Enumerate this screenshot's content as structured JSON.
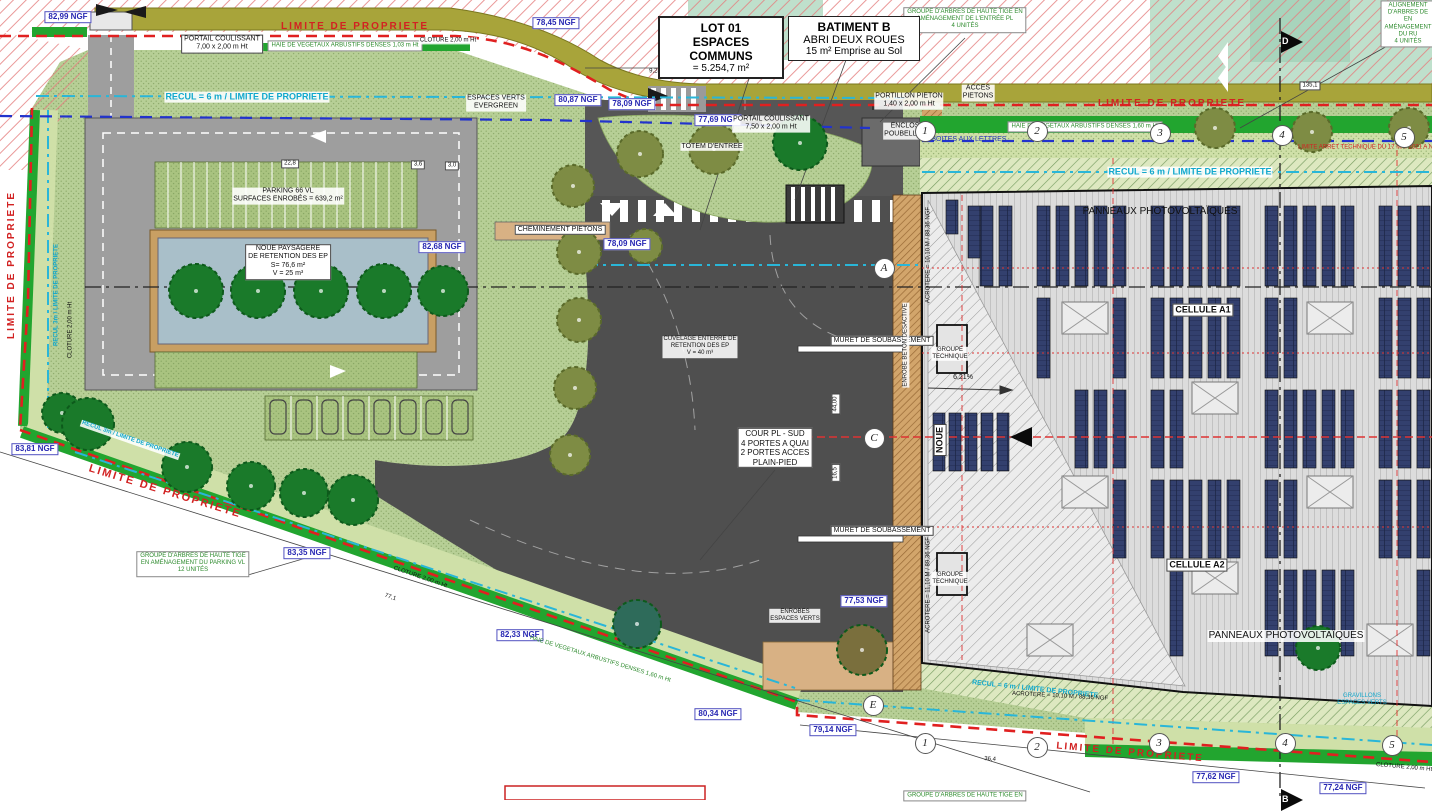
{
  "colors": {
    "grass": "#b7cf96",
    "hedge_green": "#22a52f",
    "light_band": "#cfe0a8",
    "asphalt": "#4f4f4f",
    "parking_gray": "#9e9e9e",
    "noue_blue": "#a9bfc9",
    "path_tan": "#d8b184",
    "roof_gray": "#dcdcdc",
    "panel_navy": "#33406e",
    "property_red": "#d22222",
    "recul_cyan": "#12a8cc",
    "ngf_blue": "#2626b2",
    "outside_hatch_pink": "#e57f7f",
    "verge_olive": "#a8a43a"
  },
  "title_boxes": {
    "lot": {
      "line1": "LOT 01",
      "line2": "ESPACES COMMUNS",
      "line3": "= 5.254,7 m²"
    },
    "batiment": {
      "line1": "BATIMENT B",
      "line2": "ABRI DEUX ROUES",
      "line3": "15 m² Emprise au Sol"
    }
  },
  "annotations": [
    {
      "name": "ngf-label",
      "cls": "ngf",
      "x": 68,
      "y": 17,
      "t": "82,99 NGF"
    },
    {
      "name": "ngf-label",
      "cls": "ngf",
      "x": 556,
      "y": 23,
      "t": "78,45 NGF"
    },
    {
      "name": "ngf-label",
      "cls": "ngf",
      "x": 578,
      "y": 100,
      "t": "80,87 NGF"
    },
    {
      "name": "ngf-label",
      "cls": "ngf",
      "x": 632,
      "y": 104,
      "t": "78,09 NGF"
    },
    {
      "name": "ngf-label",
      "cls": "ngf",
      "x": 718,
      "y": 120,
      "t": "77,69 NGF"
    },
    {
      "name": "ngf-label",
      "cls": "ngf",
      "x": 442,
      "y": 247,
      "t": "82,68 NGF"
    },
    {
      "name": "ngf-label",
      "cls": "ngf",
      "x": 627,
      "y": 244,
      "t": "78,09 NGF"
    },
    {
      "name": "ngf-label",
      "cls": "ngf",
      "x": 35,
      "y": 449,
      "t": "83,81 NGF"
    },
    {
      "name": "ngf-label",
      "cls": "ngf",
      "x": 307,
      "y": 553,
      "t": "83,35 NGF"
    },
    {
      "name": "ngf-label",
      "cls": "ngf",
      "x": 520,
      "y": 635,
      "t": "82,33 NGF"
    },
    {
      "name": "ngf-label",
      "cls": "ngf",
      "x": 864,
      "y": 601,
      "t": "77,53 NGF"
    },
    {
      "name": "ngf-label",
      "cls": "ngf",
      "x": 718,
      "y": 714,
      "t": "80,34 NGF"
    },
    {
      "name": "ngf-label",
      "cls": "ngf",
      "x": 833,
      "y": 730,
      "t": "79,14 NGF"
    },
    {
      "name": "ngf-label",
      "cls": "ngf",
      "x": 1216,
      "y": 777,
      "t": "77,62 NGF"
    },
    {
      "name": "ngf-label",
      "cls": "ngf",
      "x": 1343,
      "y": 788,
      "t": "77,24 NGF"
    },
    {
      "name": "gate-label",
      "cls": "wbox",
      "x": 222,
      "y": 44,
      "t": "PORTAIL COULISSANT\n7,00 x 2,00 m Ht"
    },
    {
      "name": "parking-label",
      "cls": "wbg",
      "x": 288,
      "y": 196,
      "t": "PARKING 66 VL\nSURFACES ENROBÉS = 639,2 m²"
    },
    {
      "name": "noue-label",
      "cls": "wbox",
      "x": 288,
      "y": 262,
      "t": "NOUE PAYSAGERE\nDE RETENTION DES EP\nS= 76,6 m²\nV = 25 m³"
    },
    {
      "name": "path-label",
      "cls": "wbox",
      "x": 560,
      "y": 230,
      "t": "CHEMINEMENT PIETONS"
    },
    {
      "name": "espaces-verts-label",
      "cls": "wbg",
      "x": 496,
      "y": 103,
      "t": "ESPACES VERTS\nEVERGREEN"
    },
    {
      "name": "totem-label",
      "cls": "wbg",
      "x": 712,
      "y": 147,
      "t": "TOTEM D'ENTREE"
    },
    {
      "name": "gate-label",
      "cls": "wbg",
      "x": 771,
      "y": 124,
      "t": "PORTAIL COULISSANT\n7,50 x 2,00 m Ht"
    },
    {
      "name": "portillon-label",
      "cls": "wbg",
      "x": 909,
      "y": 101,
      "t": "PORTILLON PIETON\n1,40 x 2,00 m Ht"
    },
    {
      "name": "acces-pietons-label",
      "cls": "wbg",
      "x": 978,
      "y": 93,
      "t": "ACCES\nPIETONS"
    },
    {
      "name": "enclos-label",
      "cls": "wbg",
      "x": 905,
      "y": 131,
      "t": "ENCLOS\nPOUBELLES"
    },
    {
      "name": "cuvelage-label",
      "cls": "wbg s6",
      "x": 700,
      "y": 347,
      "t": "CUVELAGE ENTERRE DE\nRETENTION DES EP\nV = 40 m³"
    },
    {
      "name": "muret-label",
      "cls": "wbox",
      "x": 882,
      "y": 341,
      "t": "MURET DE SOUBASSEMENT"
    },
    {
      "name": "muret-label",
      "cls": "wbox",
      "x": 882,
      "y": 531,
      "t": "MURET DE SOUBASSEMENT"
    },
    {
      "name": "cour-label",
      "cls": "wbox s8",
      "x": 775,
      "y": 448,
      "t": "COUR PL - SUD\n4 PORTES A QUAI\n2 PORTES ACCES\nPLAIN-PIED"
    },
    {
      "name": "groupe-technique-label",
      "cls": "wbg s6",
      "x": 950,
      "y": 354,
      "t": "GROUPE\nTECHNIQUE"
    },
    {
      "name": "groupe-technique-label",
      "cls": "wbg s6",
      "x": 950,
      "y": 579,
      "t": "GROUPE\nTECHNIQUE"
    },
    {
      "name": "cellule-a1-label",
      "cls": "wbox s9 b nw",
      "x": 1203,
      "y": 310,
      "t": "CELLULE A1"
    },
    {
      "name": "cellule-a2-label",
      "cls": "wbox s9 b nw",
      "x": 1197,
      "y": 565,
      "t": "CELLULE A2"
    },
    {
      "name": "panneaux-pv-label",
      "cls": "s10 nw",
      "x": 1160,
      "y": 212,
      "t": "PANNEAUX PHOTOVOLTAÏQUES"
    },
    {
      "name": "panneaux-pv-label",
      "cls": "s10 nw wbg",
      "x": 1286,
      "y": 636,
      "t": "PANNEAUX PHOTOVOLTAÏQUES"
    },
    {
      "name": "enrobes-label",
      "cls": "wbg s6",
      "x": 795,
      "y": 616,
      "t": "ENROBES\nESPACES VERTS"
    },
    {
      "name": "gravillons-label",
      "cls": "cyan s6",
      "x": 1362,
      "y": 700,
      "t": "GRAVILLONS\nESPACES VERTS"
    },
    {
      "name": "noue-vertical-label",
      "cls": "wbox s9 b",
      "x": 940,
      "y": 440,
      "rot": -90,
      "t": "NOUE"
    },
    {
      "name": "enrobe-beton-label",
      "cls": "wbg s6",
      "x": 906,
      "y": 345,
      "rot": -90,
      "t": "ENROBE  BETON DESACTIVE"
    },
    {
      "name": "haie-label",
      "cls": "greenbox s6 nw",
      "x": 345,
      "y": 46,
      "t": "HAIE DE VEGETAUX ARBUSTIFS DENSES 1,03 m Ht"
    },
    {
      "name": "haie-label",
      "cls": "greenbox s6 nw",
      "x": 1085,
      "y": 127,
      "t": "HAIE DE VEGETAUX ARBUSTIFS DENSES 1,60 m Ht"
    },
    {
      "name": "haie-label",
      "cls": "green s6 nw",
      "x": 600,
      "y": 660,
      "rot": 17,
      "t": "HAIE DE VEGETAUX ARBUSTIFS DENSES 1,60 m Ht"
    },
    {
      "name": "groupe-arbres-label",
      "cls": "greenbox s6",
      "x": 965,
      "y": 20,
      "t": "GROUPE D'ARBRES DE HAUTE TIGE EN\nAMÉNAGEMENT DE L'ENTRÉE PL\n4 UNITÉS"
    },
    {
      "name": "alignement-arbres-label",
      "cls": "greenbox s6",
      "x": 1408,
      "y": 24,
      "t": "ALIGNEMENT D'ARBRES DE\nEN AMÉNAGEMENT DU RU\n4 UNITÉS"
    },
    {
      "name": "groupe-arbres-label",
      "cls": "greenbox s6",
      "x": 193,
      "y": 564,
      "t": "GROUPE D'ARBRES DE HAUTE TIGE\nEN AMÉNAGEMENT DU PARKING VL\n12 UNITÉS"
    },
    {
      "name": "groupe-arbres-label",
      "cls": "greenbox s6",
      "x": 965,
      "y": 796,
      "t": "GROUPE D'ARBRES DE HAUTE TIGE EN"
    },
    {
      "name": "limite-propriete-label",
      "cls": "red s10 b ls nw",
      "x": 355,
      "y": 27,
      "t": "LIMITE DE PROPRIETE"
    },
    {
      "name": "limite-propriete-label",
      "cls": "red s10 b ls nw",
      "x": 1172,
      "y": 104,
      "t": "LIMITE DE PROPRIETE"
    },
    {
      "name": "limite-propriete-label",
      "cls": "red s10 b ls nw",
      "x": 12,
      "y": 265,
      "rot": -90,
      "t": "LIMITE DE PROPRIETE"
    },
    {
      "name": "limite-propriete-label",
      "cls": "red s11 b ls nw",
      "x": 165,
      "y": 492,
      "rot": 17,
      "t": "LIMITE DE PROPRIETE"
    },
    {
      "name": "limite-propriete-label",
      "cls": "red s10 b ls nw",
      "x": 1130,
      "y": 753,
      "rot": 5,
      "t": "LIMITE DE PROPRIETE"
    },
    {
      "name": "limite-arret-label",
      "cls": "red s6 nw",
      "x": 1370,
      "y": 148,
      "t": "LIMITE ARRET TECHNIQUE DU 17 MAI 2021 A NE..."
    },
    {
      "name": "recul-label",
      "cls": "cyan s9 b nw wbg",
      "x": 247,
      "y": 97,
      "t": "RECUL = 6 m / LIMITE DE PROPRIETE"
    },
    {
      "name": "recul-label",
      "cls": "cyan s9 b nw wbg",
      "x": 1190,
      "y": 172,
      "t": "RECUL = 6 m / LIMITE DE PROPRIETE"
    },
    {
      "name": "recul-label",
      "cls": "cyan s6 b nw",
      "x": 57,
      "y": 295,
      "rot": -90,
      "t": "RECUL 3m / LIMITE DE PROPRIETE"
    },
    {
      "name": "recul-label",
      "cls": "cyan s6 b nw wbg",
      "x": 130,
      "y": 440,
      "rot": 19,
      "t": "RECUL 3m / LIMITE DE PROPRIETE"
    },
    {
      "name": "recul-label",
      "cls": "cyan s7 b nw",
      "x": 1035,
      "y": 690,
      "rot": 6,
      "t": "RECUL = 6 m / LIMITE DE PROPRIETE"
    },
    {
      "name": "boites-lettres-label",
      "cls": "blue s7 nw",
      "x": 966,
      "y": 140,
      "t": "3 BOITES AUX LETTRES"
    },
    {
      "name": "cloture-label",
      "cls": "wbg s6 nw",
      "x": 448,
      "y": 41,
      "t": "CLOTURE 2,00 m Ht"
    },
    {
      "name": "cloture-label",
      "cls": "s6 nw",
      "x": 71,
      "y": 330,
      "rot": -90,
      "t": "CLOTURE 2,00 m Ht"
    },
    {
      "name": "cloture-label",
      "cls": "s6 nw",
      "x": 420,
      "y": 578,
      "rot": 19,
      "t": "CLOTURE 2,00 m Ht"
    },
    {
      "name": "cloture-label",
      "cls": "s6 nw",
      "x": 1404,
      "y": 768,
      "rot": 5,
      "t": "CLOTURE 2,00 m Ht"
    },
    {
      "name": "dim-label",
      "cls": "s6 nw",
      "x": 655,
      "y": 72,
      "t": "9,24"
    },
    {
      "name": "dim-label",
      "cls": "wbox s6 nw",
      "x": 290,
      "y": 164,
      "t": "22,8"
    },
    {
      "name": "dim-label",
      "cls": "wbox s6 nw",
      "x": 418,
      "y": 165,
      "t": "3,6"
    },
    {
      "name": "dim-label",
      "cls": "wbox s6 nw",
      "x": 452,
      "y": 166,
      "t": "3,0"
    },
    {
      "name": "dim-label",
      "cls": "wbox s6 nw",
      "x": 1310,
      "y": 86,
      "t": "135,1"
    },
    {
      "name": "dim-label",
      "cls": "s6 nw",
      "x": 990,
      "y": 760,
      "rot": 4,
      "t": "36,4"
    },
    {
      "name": "dim-label",
      "cls": "s6 nw",
      "x": 390,
      "y": 598,
      "rot": 19,
      "t": "77,1"
    },
    {
      "name": "dim-label",
      "cls": "wbox s6 nw",
      "x": 836,
      "y": 404,
      "rot": -90,
      "t": "44,00"
    },
    {
      "name": "dim-label",
      "cls": "wbox s6 nw",
      "x": 836,
      "y": 473,
      "rot": -90,
      "t": "16,5"
    },
    {
      "name": "slope-label",
      "cls": "s7 nw",
      "x": 963,
      "y": 378,
      "t": "6,21%"
    },
    {
      "name": "acrotere-label",
      "cls": "s6 nw",
      "x": 1060,
      "y": 697,
      "rot": 3,
      "t": "ACROTERE = 10,10 M / 88,36 NGF"
    },
    {
      "name": "acrotere-label",
      "cls": "s6 nw",
      "x": 929,
      "y": 255,
      "rot": -90,
      "t": "ACROTERE = 10,10 M / 88,36 NGF"
    },
    {
      "name": "acrotere-label",
      "cls": "s6 nw",
      "x": 929,
      "y": 585,
      "rot": -90,
      "t": "ACROTERE = 11,10 M / 89,36 NGF"
    }
  ],
  "grid_bubbles": [
    {
      "t": "1",
      "x": 924,
      "y": 130
    },
    {
      "t": "2",
      "x": 1036,
      "y": 130
    },
    {
      "t": "3",
      "x": 1159,
      "y": 132
    },
    {
      "t": "4",
      "x": 1281,
      "y": 134
    },
    {
      "t": "5",
      "x": 1403,
      "y": 136
    },
    {
      "t": "1",
      "x": 924,
      "y": 742
    },
    {
      "t": "2",
      "x": 1036,
      "y": 746
    },
    {
      "t": "3",
      "x": 1158,
      "y": 742
    },
    {
      "t": "4",
      "x": 1284,
      "y": 742
    },
    {
      "t": "5",
      "x": 1391,
      "y": 744
    },
    {
      "t": "A",
      "x": 883,
      "y": 267
    },
    {
      "t": "C",
      "x": 873,
      "y": 437
    },
    {
      "t": "E",
      "x": 872,
      "y": 704
    }
  ],
  "section_flags": [
    {
      "t": "D",
      "x": 1281,
      "y": 31
    },
    {
      "t": "B",
      "x": 1281,
      "y": 789
    }
  ]
}
